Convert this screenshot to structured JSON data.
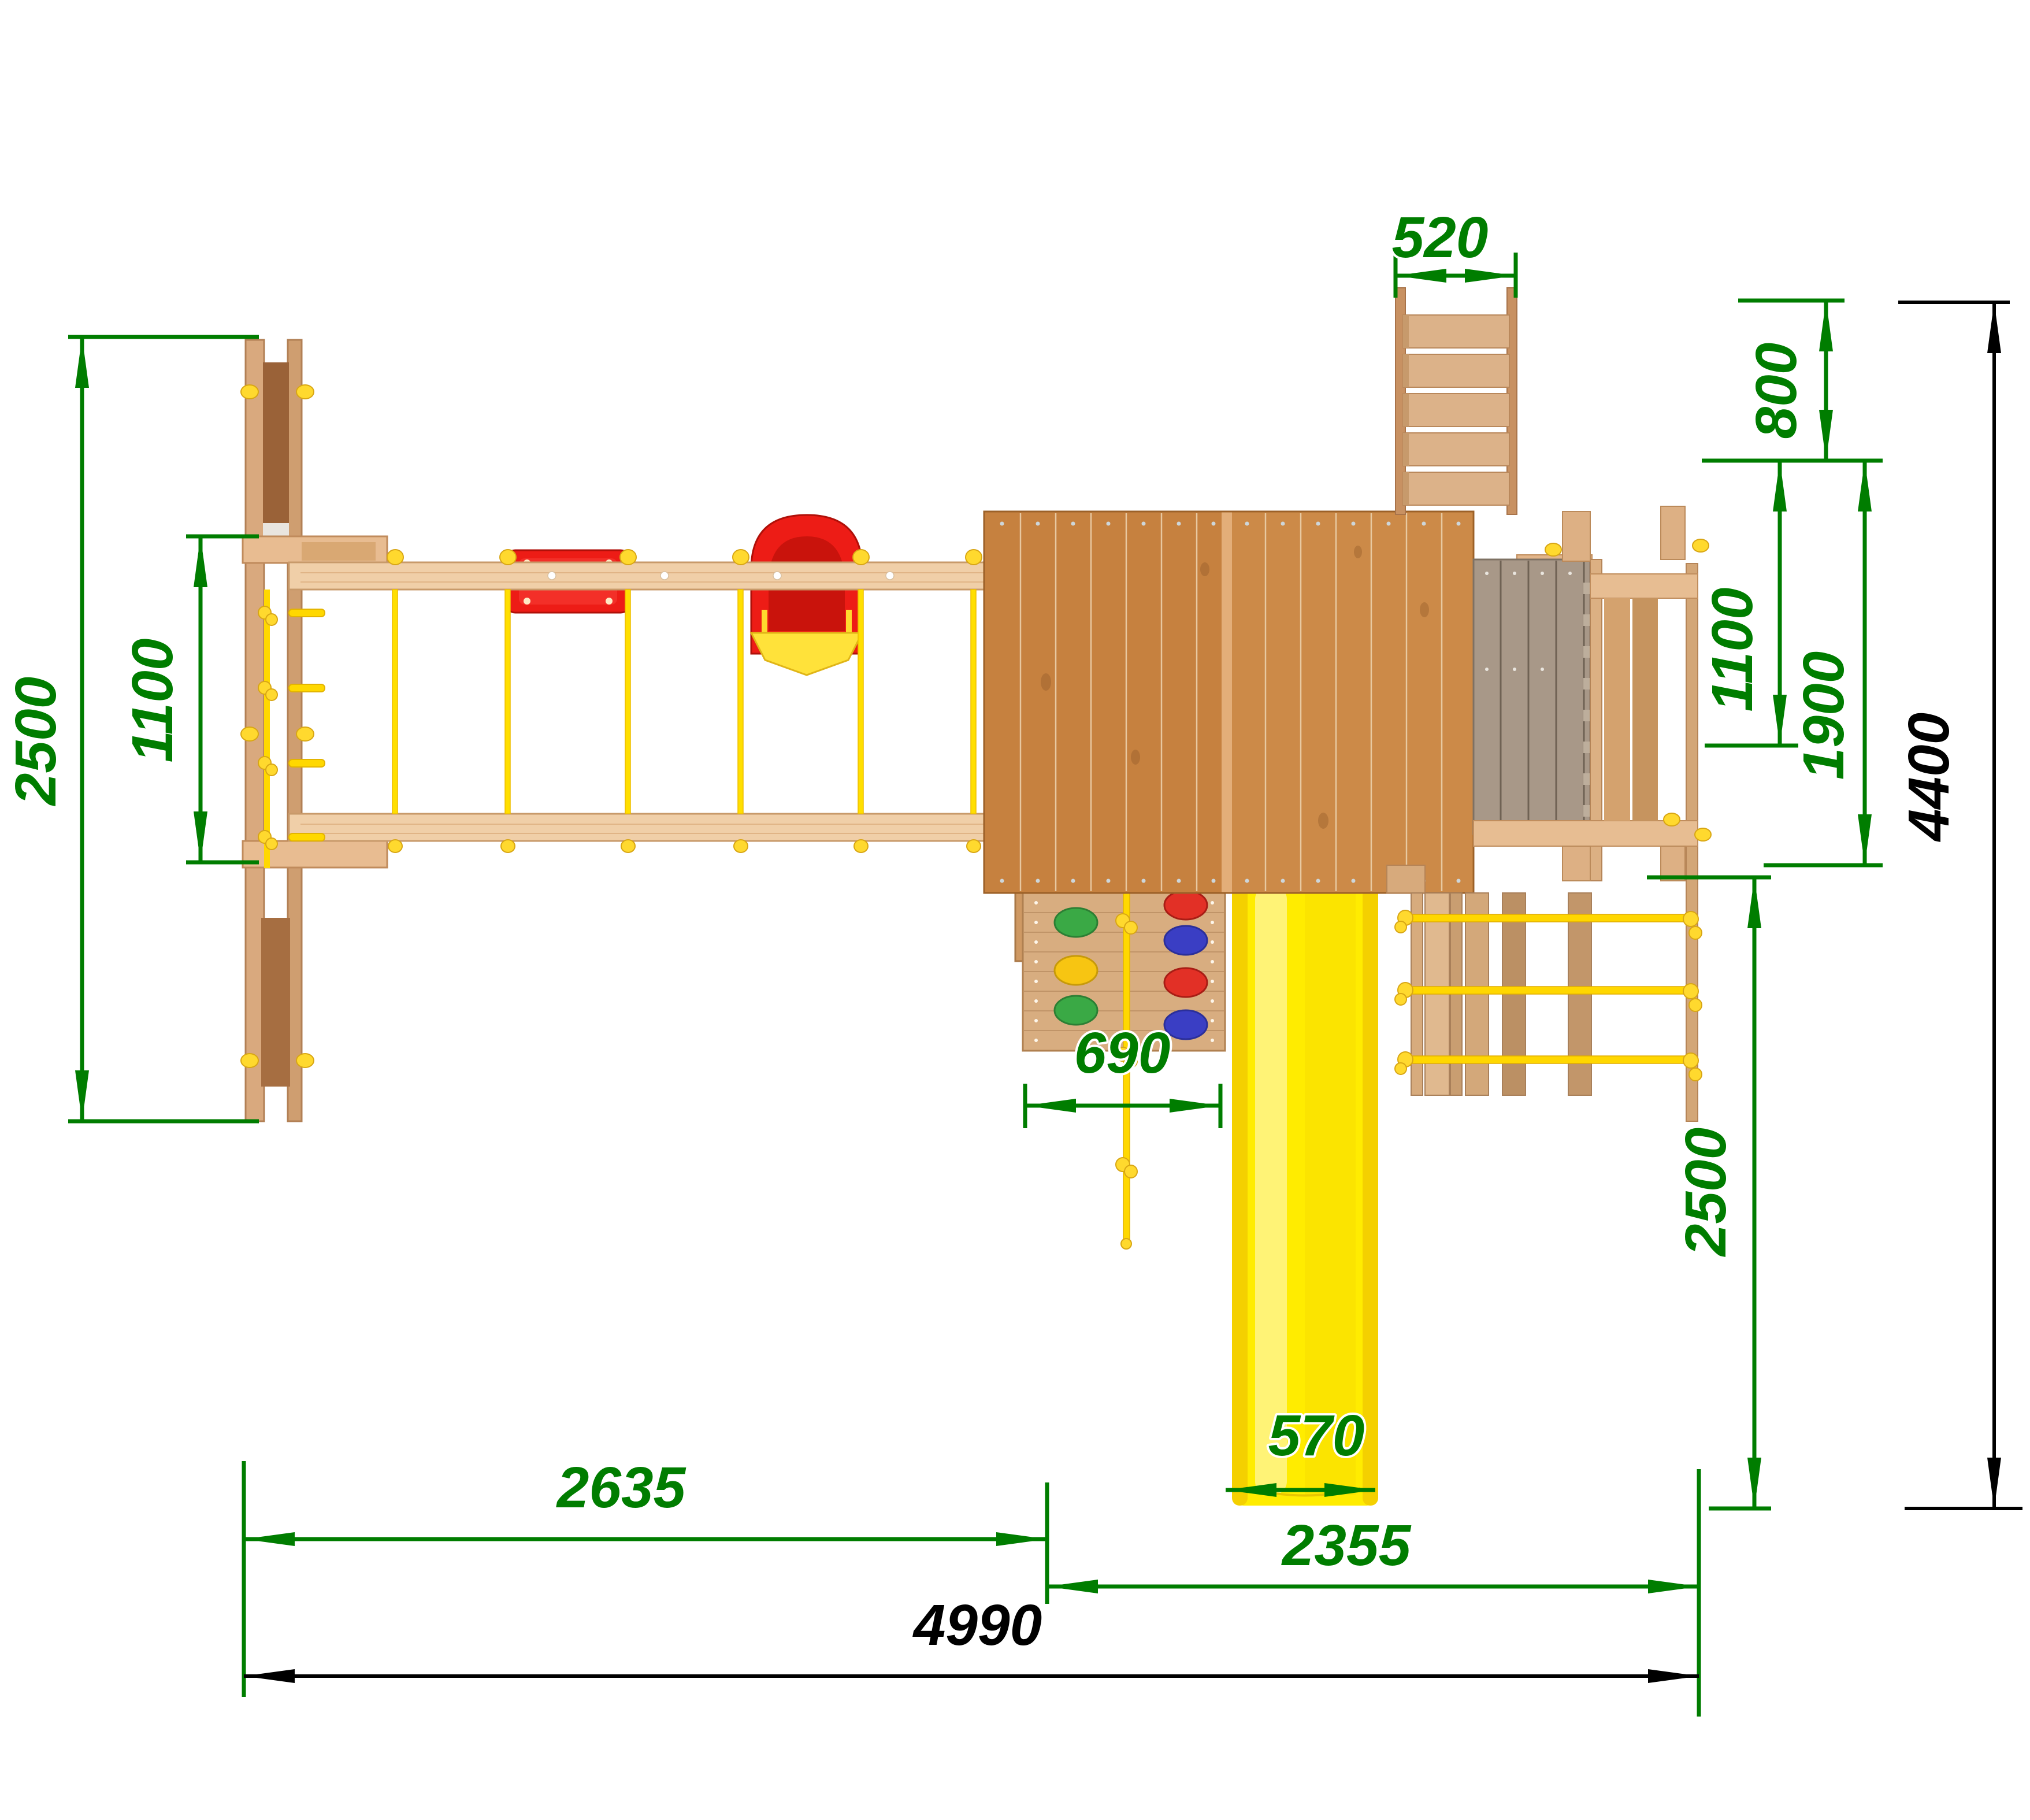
{
  "drawing": {
    "kind": "playground-set-top-view-plan",
    "units_implied": "mm"
  },
  "dims": {
    "d520": {
      "label": "520"
    },
    "d800": {
      "label": "800"
    },
    "d2500_left": {
      "label": "2500"
    },
    "d1100_left": {
      "label": "1100"
    },
    "d1100_right": {
      "label": "1100"
    },
    "d1900": {
      "label": "1900"
    },
    "d2500_right": {
      "label": "2500"
    },
    "d4400": {
      "label": "4400"
    },
    "d690": {
      "label": "690"
    },
    "d570": {
      "label": "570"
    },
    "d2635": {
      "label": "2635"
    },
    "d2355": {
      "label": "2355"
    },
    "d4990": {
      "label": "4990"
    }
  },
  "colors": {
    "dimension_green": "#007d00",
    "dimension_black": "#000000",
    "beam_wood": "#f0cfa8",
    "rail_wood": "#d9a97e",
    "panel_dark": "#9a6238",
    "roof_left": "#c6813f",
    "roof_right": "#cc8a48",
    "roof_ridge": "#e3ae79",
    "wall_wood": "#d8ad80",
    "deck_gray": "#a89888",
    "slide_yellow": "#ffec00",
    "rope_yellow": "#ffd800",
    "knob_yellow": "#ffd92e",
    "seat_red": "#ed1c16",
    "bumper_yellow": "#ffe23a",
    "hold_green": "#3aa945",
    "hold_yellow": "#f7c512",
    "hold_red": "#e23026",
    "hold_blue": "#3a3ec4"
  }
}
